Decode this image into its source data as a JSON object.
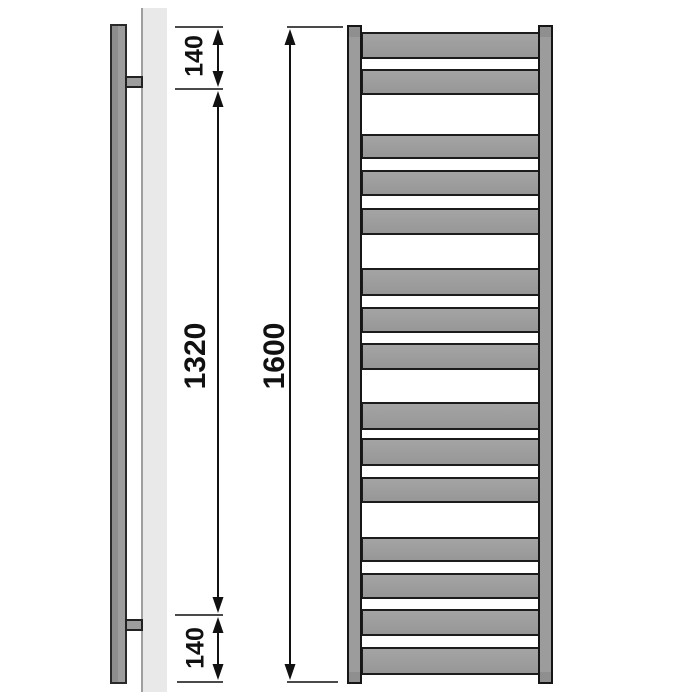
{
  "dimensions": {
    "top_offset": "140",
    "middle_span": "1320",
    "bottom_offset": "140",
    "overall_height": "1600"
  },
  "colors": {
    "metal_fill": "#9e9e9e",
    "metal_outline": "#1c1c1c",
    "wall_fill": "#e9e9e9",
    "wall_edge": "#9f9f9f",
    "dimension_line": "#111111",
    "tick_line": "#4a4a4a",
    "background": "#ffffff"
  },
  "front_view": {
    "bar_left": 361,
    "bar_width": 179,
    "bars": [
      {
        "y": 32,
        "h": 27
      },
      {
        "y": 69,
        "h": 26
      },
      {
        "y": 134,
        "h": 25
      },
      {
        "y": 170,
        "h": 26
      },
      {
        "y": 208,
        "h": 27
      },
      {
        "y": 268,
        "h": 28
      },
      {
        "y": 307,
        "h": 26
      },
      {
        "y": 343,
        "h": 27
      },
      {
        "y": 402,
        "h": 28
      },
      {
        "y": 438,
        "h": 28
      },
      {
        "y": 477,
        "h": 26
      },
      {
        "y": 537,
        "h": 25
      },
      {
        "y": 573,
        "h": 26
      },
      {
        "y": 609,
        "h": 27
      },
      {
        "y": 647,
        "h": 28
      }
    ]
  },
  "annotations": {
    "ticks": [
      {
        "x1": 175,
        "x2": 223,
        "y": 27
      },
      {
        "x1": 287,
        "x2": 343,
        "y": 27
      },
      {
        "x1": 175,
        "x2": 223,
        "y": 89
      },
      {
        "x1": 175,
        "x2": 223,
        "y": 615
      },
      {
        "x1": 177,
        "x2": 223,
        "y": 682
      },
      {
        "x1": 287,
        "x2": 338,
        "y": 682
      }
    ],
    "arrows": [
      {
        "x": 218,
        "y1": 29,
        "y2": 87
      },
      {
        "x": 218,
        "y1": 91,
        "y2": 613
      },
      {
        "x": 218,
        "y1": 617,
        "y2": 680
      },
      {
        "x": 290,
        "y1": 29,
        "y2": 680
      }
    ]
  }
}
